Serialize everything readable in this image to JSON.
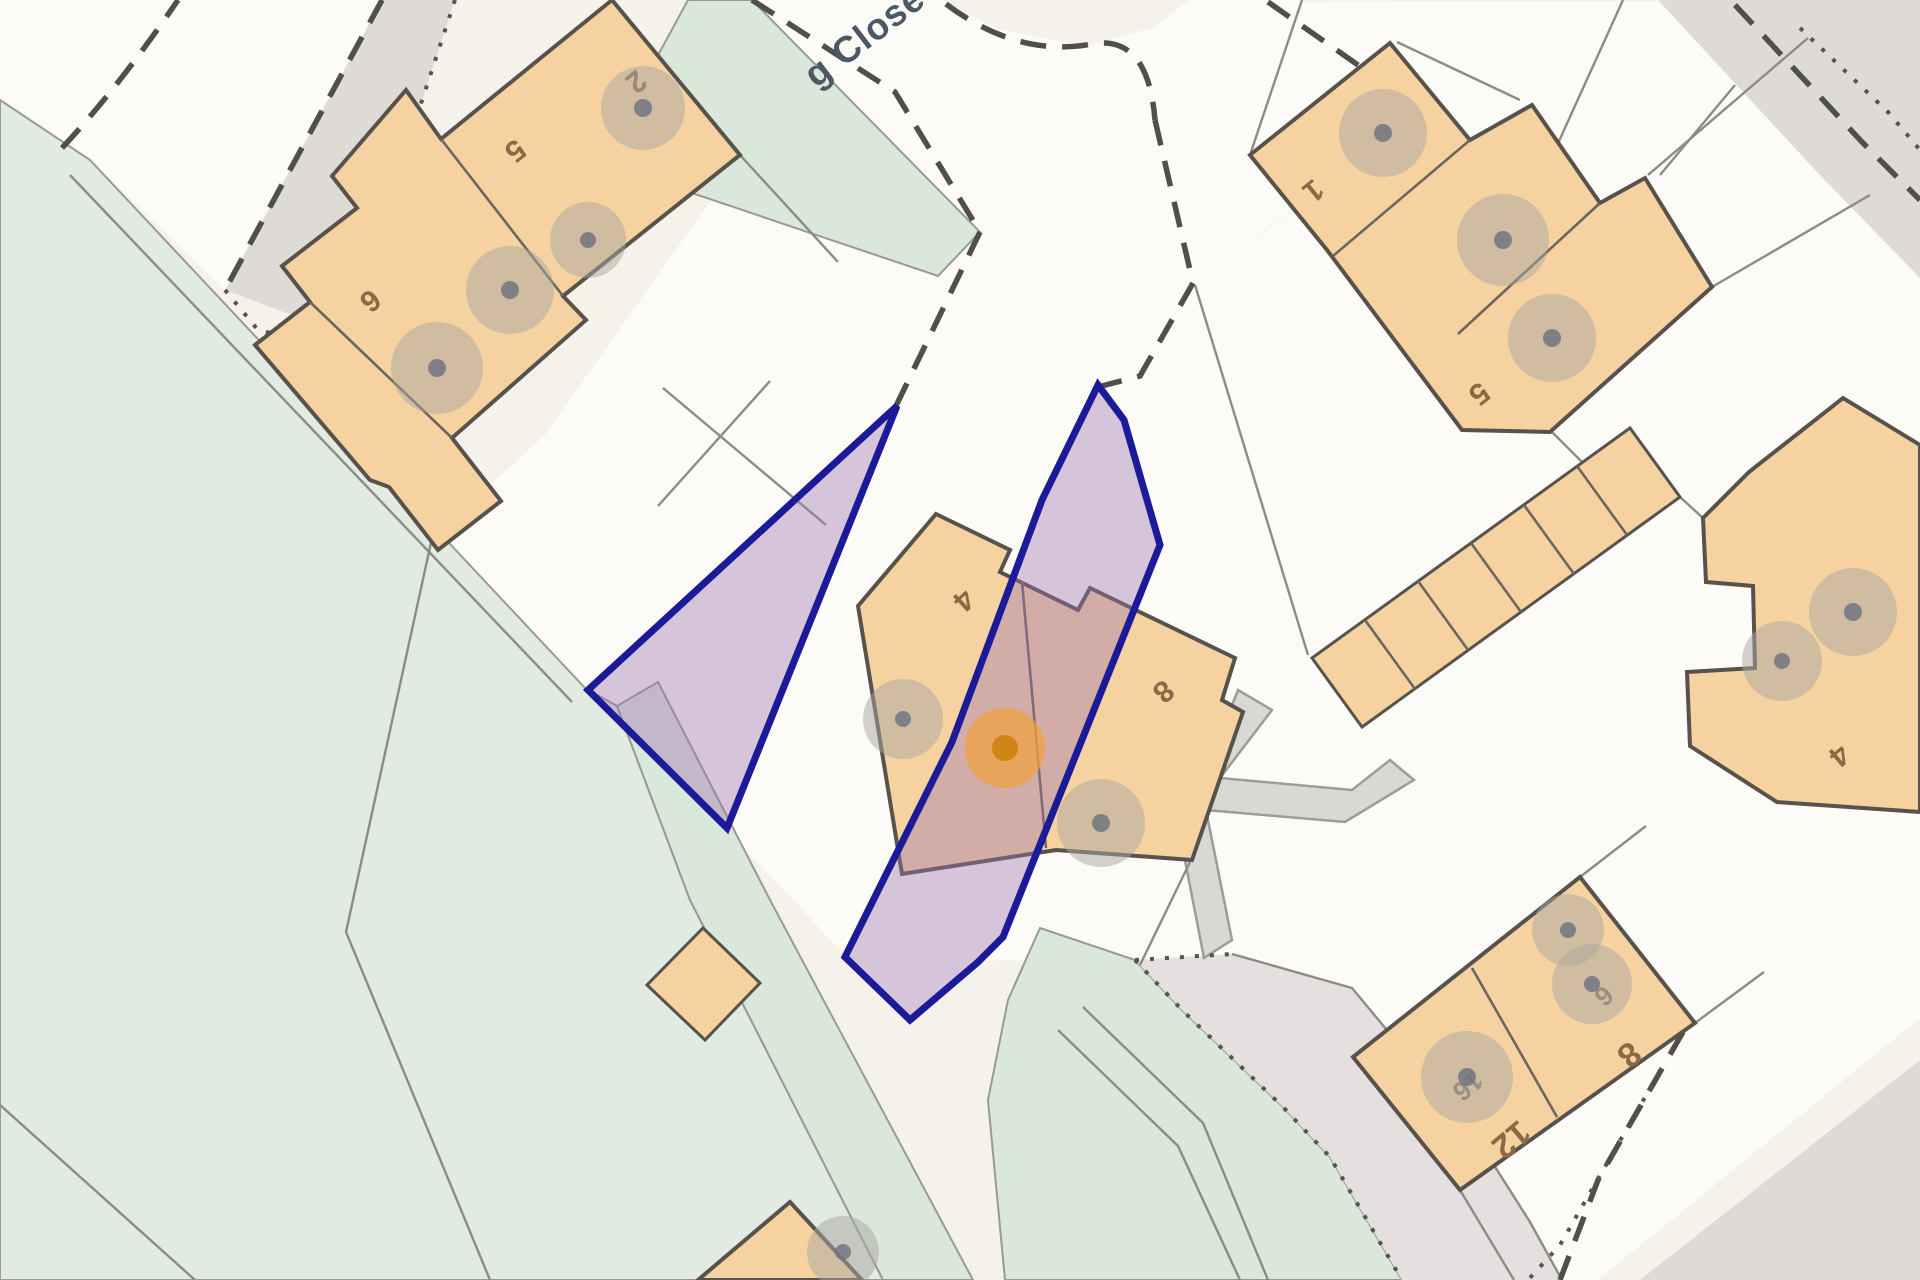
{
  "map_view": {
    "street_label": "g Close",
    "plot_labels": {
      "terrace_2": "2",
      "terrace_5": "5",
      "terrace_6": "6",
      "block_ne_1": "1",
      "block_ne_5": "5",
      "central_4": "4",
      "central_8": "8",
      "east_4": "4",
      "south_12": "12",
      "south_8": "8",
      "south_6": "6",
      "south_16": "16"
    },
    "selection": {
      "parcel_count": 2,
      "outline_color": "#1b1b9a",
      "fill_color": "#9e72b0",
      "marker_color": "#e8951d"
    },
    "surface_colors": {
      "building": "#f6d2a0",
      "field": "#e1ebe2",
      "footpath": "#dae7db",
      "road_surface": "#fcfbf8",
      "unadopted_road": "#dedad6",
      "hardstanding": "#e5e0df",
      "background": "#f4f2ea"
    }
  }
}
